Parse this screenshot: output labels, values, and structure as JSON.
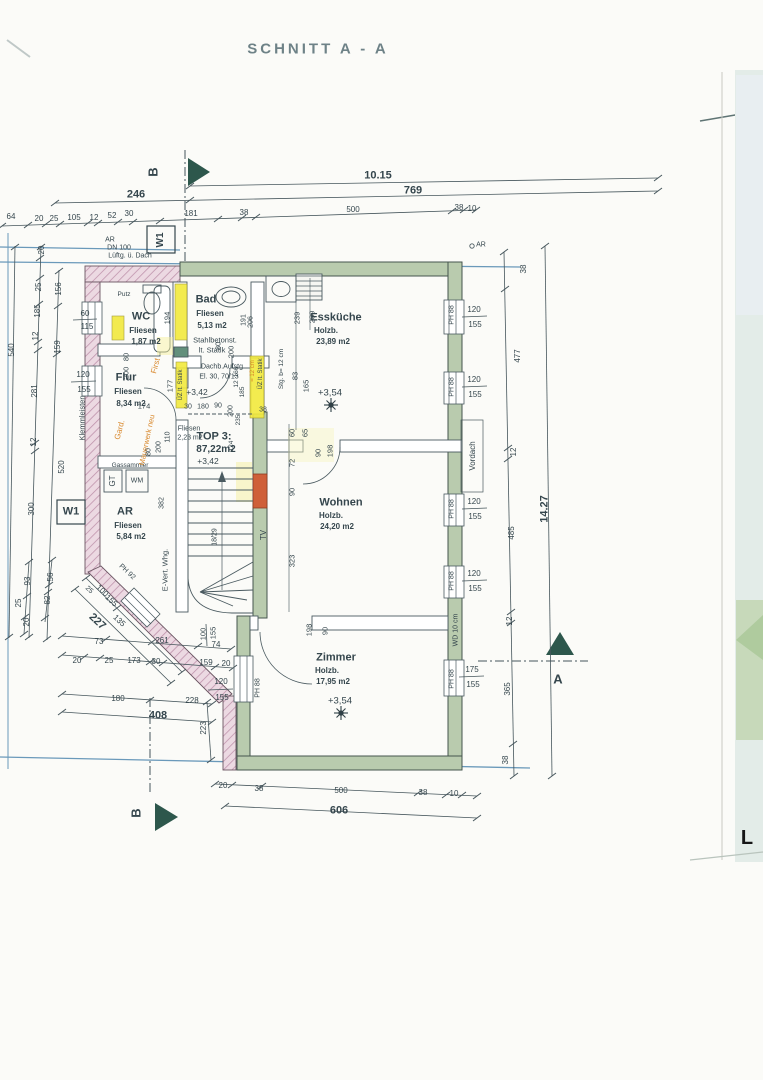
{
  "page": {
    "title": "SCHNITT A - A",
    "photo_letter": "L"
  },
  "palette": {
    "ink": "#35464d",
    "faded": "#6e8287",
    "orange": "#d8872b",
    "red": "#c44f2e",
    "black": "#161616",
    "green_wall": "#b9cbae",
    "pink_wall": "#ecd9e2",
    "yellow": "#f2e93d",
    "blue_line": "#5b8fb4",
    "teal": "#2d574c"
  },
  "rooms": [
    {
      "name": "WC",
      "finish": "Fliesen",
      "area": "1,87 m2"
    },
    {
      "name": "Bad",
      "finish": "Fliesen",
      "area": "5,13 m2",
      "note": "Stahlbetonst. lt. Statik"
    },
    {
      "name": "Flur",
      "finish": "Fliesen",
      "area": "8,34 m2"
    },
    {
      "name": "AR",
      "finish": "Fliesen",
      "area": "5,84 m2"
    },
    {
      "name": "Essküche",
      "finish": "Holzb.",
      "area": "23,89 m2",
      "level": "+3,54"
    },
    {
      "name": "Wohnen",
      "finish": "Holzb.",
      "area": "24,20 m2"
    },
    {
      "name": "Zimmer",
      "finish": "Holzb.",
      "area": "17,95 m2",
      "level": "+3,54"
    },
    {
      "name": "TOP 3:",
      "area": "87,22m2"
    }
  ],
  "labels": [
    {
      "n": "drawing-title",
      "t": "SCHNITT A - A",
      "x": 318,
      "y": 49,
      "s": 15,
      "c": "faded",
      "w": 600,
      "ls": 3
    },
    {
      "n": "photo-letter",
      "t": "L",
      "x": 747,
      "y": 838,
      "s": 20,
      "w": 700,
      "c": "black"
    },
    {
      "n": "dim-total-top",
      "t": "10.15",
      "x": 378,
      "y": 176,
      "s": 11,
      "w": 600
    },
    {
      "t": "246",
      "x": 136,
      "y": 195,
      "s": 11,
      "w": 600
    },
    {
      "t": "769",
      "x": 413,
      "y": 191,
      "s": 11,
      "w": 600
    },
    {
      "t": "64",
      "x": 11,
      "y": 217
    },
    {
      "t": "20",
      "x": 39,
      "y": 219
    },
    {
      "t": "25",
      "x": 54,
      "y": 219
    },
    {
      "t": "105",
      "x": 74,
      "y": 218
    },
    {
      "t": "12",
      "x": 94,
      "y": 218
    },
    {
      "t": "52",
      "x": 112,
      "y": 216
    },
    {
      "t": "30",
      "x": 129,
      "y": 214
    },
    {
      "t": "181",
      "x": 191,
      "y": 214
    },
    {
      "t": "38",
      "x": 244,
      "y": 213
    },
    {
      "t": "500",
      "x": 353,
      "y": 210
    },
    {
      "t": "38",
      "x": 459,
      "y": 208
    },
    {
      "t": "10",
      "x": 472,
      "y": 209
    },
    {
      "n": "section-b-top",
      "t": "B",
      "x": 153,
      "y": 172,
      "s": 13,
      "r": -90,
      "w": 600
    },
    {
      "n": "section-b-bottom",
      "t": "B",
      "x": 136,
      "y": 813,
      "s": 13,
      "r": -90,
      "w": 600
    },
    {
      "n": "section-a",
      "t": "A",
      "x": 558,
      "y": 679,
      "s": 13,
      "w": 600
    },
    {
      "n": "wall-tag-w1-top",
      "t": "W1",
      "x": 161,
      "y": 240,
      "s": 10,
      "r": -90,
      "w": 700
    },
    {
      "n": "wall-tag-w1-left",
      "t": "W1",
      "x": 71,
      "y": 512,
      "s": 11,
      "w": 700
    },
    {
      "t": "AR",
      "x": 110,
      "y": 240,
      "s": 7
    },
    {
      "t": "DN 100",
      "x": 119,
      "y": 248,
      "s": 7
    },
    {
      "t": "Lüftg. ü. Dach",
      "x": 130,
      "y": 256,
      "s": 7
    },
    {
      "t": "AR",
      "x": 481,
      "y": 245,
      "s": 7
    },
    {
      "n": "room-wc",
      "t": "WC",
      "x": 141,
      "y": 317,
      "s": 11,
      "w": 700
    },
    {
      "t": "Fliesen",
      "x": 143,
      "y": 331,
      "s": 8,
      "w": 600
    },
    {
      "t": "1,87 m2",
      "x": 146,
      "y": 342,
      "s": 8,
      "w": 600
    },
    {
      "n": "room-bad",
      "t": "Bad",
      "x": 206,
      "y": 300,
      "s": 11,
      "w": 700
    },
    {
      "t": "Fliesen",
      "x": 210,
      "y": 314,
      "s": 8,
      "w": 600
    },
    {
      "t": "5,13 m2",
      "x": 212,
      "y": 326,
      "s": 8,
      "w": 600
    },
    {
      "t": "Stahlbetonst.",
      "x": 215,
      "y": 340,
      "s": 7.5
    },
    {
      "t": "lt. Statik",
      "x": 212,
      "y": 350,
      "s": 7.5
    },
    {
      "n": "room-flur",
      "t": "Flur",
      "x": 126,
      "y": 378,
      "s": 11,
      "w": 700
    },
    {
      "t": "Fliesen",
      "x": 128,
      "y": 392,
      "s": 8,
      "w": 600
    },
    {
      "t": "8,34 m2",
      "x": 131,
      "y": 404,
      "s": 8,
      "w": 600
    },
    {
      "n": "room-ar",
      "t": "AR",
      "x": 125,
      "y": 512,
      "s": 11,
      "w": 700
    },
    {
      "t": "Fliesen",
      "x": 128,
      "y": 526,
      "s": 8,
      "w": 600
    },
    {
      "t": "5,84 m2",
      "x": 131,
      "y": 537,
      "s": 8,
      "w": 600
    },
    {
      "n": "room-esskueche",
      "t": "Essküche",
      "x": 336,
      "y": 318,
      "s": 11,
      "w": 700
    },
    {
      "t": "Holzb.",
      "x": 326,
      "y": 331,
      "s": 8,
      "w": 600
    },
    {
      "t": "23,89 m2",
      "x": 333,
      "y": 342,
      "s": 8,
      "w": 600
    },
    {
      "n": "room-wohnen",
      "t": "Wohnen",
      "x": 341,
      "y": 503,
      "s": 11,
      "w": 700
    },
    {
      "t": "Holzb.",
      "x": 331,
      "y": 516,
      "s": 8,
      "w": 600
    },
    {
      "t": "24,20 m2",
      "x": 337,
      "y": 527,
      "s": 8,
      "w": 600
    },
    {
      "n": "room-zimmer",
      "t": "Zimmer",
      "x": 336,
      "y": 658,
      "s": 11,
      "w": 700
    },
    {
      "t": "Holzb.",
      "x": 327,
      "y": 671,
      "s": 8,
      "w": 600
    },
    {
      "t": "17,95 m2",
      "x": 333,
      "y": 682,
      "s": 8,
      "w": 600
    },
    {
      "n": "unit-label",
      "t": "TOP 3:",
      "x": 214,
      "y": 437,
      "s": 11,
      "w": 700
    },
    {
      "n": "unit-area",
      "t": "87,22m2",
      "x": 216,
      "y": 450,
      "s": 10,
      "w": 700
    },
    {
      "t": "Fliesen",
      "x": 189,
      "y": 429,
      "s": 7
    },
    {
      "t": "2,23 m2",
      "x": 190,
      "y": 438,
      "s": 7
    },
    {
      "n": "level-esskueche",
      "t": "+3,54",
      "x": 330,
      "y": 393,
      "s": 9.5
    },
    {
      "n": "level-zimmer",
      "t": "+3,54",
      "x": 340,
      "y": 701,
      "s": 9.5
    },
    {
      "t": "+3,42",
      "x": 197,
      "y": 392,
      "s": 8.5
    },
    {
      "t": "+3,42",
      "x": 208,
      "y": 461,
      "s": 8.5
    },
    {
      "t": "Dachb.Aufstg",
      "x": 222,
      "y": 367,
      "s": 7
    },
    {
      "t": "El. 30, 70/13",
      "x": 219,
      "y": 377,
      "s": 7
    },
    {
      "t": "Putz",
      "x": 124,
      "y": 295,
      "s": 6.5
    },
    {
      "t": "Gassammler",
      "x": 130,
      "y": 466,
      "s": 6.5
    },
    {
      "t": "WM",
      "x": 137,
      "y": 481,
      "s": 7
    },
    {
      "t": "GT",
      "x": 113,
      "y": 481,
      "s": 8,
      "r": -90
    },
    {
      "t": "E-Vert. Whg.",
      "x": 165,
      "y": 570,
      "s": 7.5,
      "r": -90
    },
    {
      "t": "Klemmleisten",
      "x": 82,
      "y": 418,
      "s": 7.5,
      "r": -90
    },
    {
      "t": "TV",
      "x": 264,
      "y": 535,
      "s": 8,
      "r": -90
    },
    {
      "t": "Vordach",
      "x": 473,
      "y": 456,
      "s": 8,
      "r": -90
    },
    {
      "t": "WD 10 cm",
      "x": 456,
      "y": 630,
      "s": 7,
      "r": -90
    },
    {
      "t": "First",
      "x": 156,
      "y": 366,
      "s": 8,
      "r": -75,
      "c": "orange"
    },
    {
      "t": "Gard.",
      "x": 120,
      "y": 430,
      "s": 8,
      "r": -75,
      "c": "orange"
    },
    {
      "t": "Mauerwerk neu",
      "x": 147,
      "y": 440,
      "s": 7.5,
      "r": -78,
      "c": "orange"
    },
    {
      "t": "194",
      "x": 167,
      "y": 318,
      "s": 7.5,
      "r": -90
    },
    {
      "t": "191",
      "x": 244,
      "y": 320,
      "s": 7,
      "r": -90
    },
    {
      "t": "206",
      "x": 251,
      "y": 322,
      "s": 7,
      "r": -90
    },
    {
      "t": "80",
      "x": 126,
      "y": 357,
      "s": 7.5,
      "r": -90
    },
    {
      "t": "200",
      "x": 126,
      "y": 373,
      "s": 7.5,
      "r": -90
    },
    {
      "t": "80",
      "x": 218,
      "y": 346,
      "s": 7.5,
      "r": -90
    },
    {
      "t": "200",
      "x": 231,
      "y": 352,
      "s": 7.5,
      "r": -90
    },
    {
      "t": "174",
      "x": 144,
      "y": 406,
      "s": 7.5
    },
    {
      "t": "177",
      "x": 170,
      "y": 386,
      "s": 7.5,
      "r": -90
    },
    {
      "t": "ÜZ lt. Statik",
      "x": 181,
      "y": 385,
      "s": 6,
      "r": -90
    },
    {
      "t": "= 12 cm",
      "x": 253,
      "y": 371,
      "s": 6,
      "r": -90,
      "c": "orange"
    },
    {
      "t": "ÜZ lt. Statik",
      "x": 261,
      "y": 374,
      "s": 6,
      "r": -90
    },
    {
      "t": "Stg. b= 12 cm",
      "x": 282,
      "y": 369,
      "s": 6.5,
      "r": -90
    },
    {
      "t": "239",
      "x": 297,
      "y": 318,
      "s": 7.5,
      "r": -90
    },
    {
      "t": "239",
      "x": 312,
      "y": 317,
      "s": 7.5,
      "r": -90
    },
    {
      "t": "83",
      "x": 295,
      "y": 376,
      "s": 7.5,
      "r": -90
    },
    {
      "t": "165",
      "x": 306,
      "y": 386,
      "s": 7.5,
      "r": -90
    },
    {
      "t": "60",
      "x": 292,
      "y": 433,
      "s": 7.5,
      "r": -90
    },
    {
      "t": "65",
      "x": 305,
      "y": 433,
      "s": 7.5,
      "r": -90
    },
    {
      "t": "72",
      "x": 292,
      "y": 463,
      "s": 7.5,
      "r": -90
    },
    {
      "t": "90",
      "x": 292,
      "y": 492,
      "s": 7.5,
      "r": -90
    },
    {
      "t": "90",
      "x": 318,
      "y": 453,
      "s": 7.5,
      "r": -90
    },
    {
      "t": "198",
      "x": 330,
      "y": 451,
      "s": 7.5,
      "r": -90
    },
    {
      "t": "323",
      "x": 292,
      "y": 561,
      "s": 7.5,
      "r": -90
    },
    {
      "t": "198",
      "x": 309,
      "y": 630,
      "s": 7.5,
      "r": -90
    },
    {
      "t": "90",
      "x": 325,
      "y": 631,
      "s": 7.5,
      "r": -90
    },
    {
      "t": "18/29",
      "x": 215,
      "y": 537,
      "s": 7,
      "r": -90
    },
    {
      "t": "30",
      "x": 188,
      "y": 407,
      "s": 7
    },
    {
      "t": "180",
      "x": 203,
      "y": 407,
      "s": 7
    },
    {
      "t": "90",
      "x": 218,
      "y": 406,
      "s": 7
    },
    {
      "t": "200",
      "x": 231,
      "y": 411,
      "s": 7,
      "r": -90
    },
    {
      "t": "166",
      "x": 237,
      "y": 372,
      "s": 6.5,
      "r": -90
    },
    {
      "t": "12",
      "x": 237,
      "y": 384,
      "s": 6.5,
      "r": -90
    },
    {
      "t": "185",
      "x": 243,
      "y": 392,
      "s": 6.5,
      "r": -90
    },
    {
      "t": "235",
      "x": 239,
      "y": 420,
      "s": 6.5,
      "r": -90
    },
    {
      "t": "124",
      "x": 232,
      "y": 446,
      "s": 6.5,
      "r": -90
    },
    {
      "t": "38",
      "x": 263,
      "y": 410,
      "s": 7
    },
    {
      "t": "382",
      "x": 162,
      "y": 503,
      "s": 7,
      "r": -90
    },
    {
      "t": "80",
      "x": 149,
      "y": 452,
      "s": 7,
      "r": -90
    },
    {
      "t": "200",
      "x": 159,
      "y": 447,
      "s": 7,
      "r": -90
    },
    {
      "t": "110",
      "x": 168,
      "y": 437,
      "s": 7,
      "r": -90
    },
    {
      "t": "540",
      "x": 12,
      "y": 350,
      "s": 8,
      "r": -90
    },
    {
      "t": "20",
      "x": 42,
      "y": 250,
      "s": 8,
      "r": -90
    },
    {
      "t": "25",
      "x": 39,
      "y": 287,
      "s": 8,
      "r": -90
    },
    {
      "t": "185",
      "x": 38,
      "y": 311,
      "s": 8,
      "r": -90
    },
    {
      "t": "12",
      "x": 36,
      "y": 336,
      "s": 8,
      "r": -90
    },
    {
      "t": "281",
      "x": 35,
      "y": 391,
      "s": 8,
      "r": -90
    },
    {
      "t": "12",
      "x": 34,
      "y": 442,
      "s": 8,
      "r": -90
    },
    {
      "t": "520",
      "x": 62,
      "y": 467,
      "s": 8,
      "r": -90
    },
    {
      "t": "300",
      "x": 32,
      "y": 509,
      "s": 8,
      "r": -90
    },
    {
      "t": "156",
      "x": 59,
      "y": 289,
      "s": 8,
      "r": -90
    },
    {
      "t": "159",
      "x": 58,
      "y": 347,
      "s": 8,
      "r": -90
    },
    {
      "t": "60",
      "x": 85,
      "y": 314,
      "s": 8
    },
    {
      "t": "115",
      "x": 87,
      "y": 327,
      "s": 8
    },
    {
      "t": "120",
      "x": 83,
      "y": 375,
      "s": 8
    },
    {
      "t": "155",
      "x": 84,
      "y": 390,
      "s": 8
    },
    {
      "t": "25",
      "x": 19,
      "y": 603,
      "s": 8,
      "r": -90
    },
    {
      "t": "93",
      "x": 28,
      "y": 581,
      "s": 8,
      "r": -90
    },
    {
      "t": "20",
      "x": 27,
      "y": 622,
      "s": 8,
      "r": -90
    },
    {
      "t": "82",
      "x": 48,
      "y": 600,
      "s": 8,
      "r": -90
    },
    {
      "t": "56",
      "x": 51,
      "y": 577,
      "s": 8,
      "r": -90
    },
    {
      "n": "dim-diagonal",
      "t": "227",
      "x": 97,
      "y": 622,
      "s": 11,
      "w": 700,
      "r": 43
    },
    {
      "t": "135",
      "x": 119,
      "y": 621,
      "s": 8,
      "r": 43
    },
    {
      "t": "100",
      "x": 102,
      "y": 591,
      "s": 8,
      "r": 43
    },
    {
      "t": "155",
      "x": 111,
      "y": 601,
      "s": 8,
      "r": 43
    },
    {
      "t": "25",
      "x": 89,
      "y": 590,
      "s": 7,
      "r": 43
    },
    {
      "t": "PH 92",
      "x": 127,
      "y": 572,
      "s": 7,
      "r": 43
    },
    {
      "t": "73",
      "x": 99,
      "y": 642,
      "s": 8
    },
    {
      "t": "261",
      "x": 162,
      "y": 641,
      "s": 8
    },
    {
      "t": "74",
      "x": 216,
      "y": 645,
      "s": 8
    },
    {
      "t": "20",
      "x": 77,
      "y": 661,
      "s": 8
    },
    {
      "t": "25",
      "x": 109,
      "y": 661,
      "s": 8
    },
    {
      "t": "173",
      "x": 134,
      "y": 661,
      "s": 8
    },
    {
      "t": "30",
      "x": 156,
      "y": 662,
      "s": 8
    },
    {
      "t": "159",
      "x": 206,
      "y": 663,
      "s": 8
    },
    {
      "t": "20",
      "x": 226,
      "y": 664,
      "s": 8
    },
    {
      "t": "100",
      "x": 203,
      "y": 634,
      "s": 7.5,
      "r": -90
    },
    {
      "t": "155",
      "x": 213,
      "y": 633,
      "s": 7.5,
      "r": -90
    },
    {
      "t": "120",
      "x": 221,
      "y": 682,
      "s": 8
    },
    {
      "t": "155",
      "x": 222,
      "y": 698,
      "s": 8
    },
    {
      "t": "180",
      "x": 118,
      "y": 699,
      "s": 8
    },
    {
      "t": "228",
      "x": 192,
      "y": 701,
      "s": 8
    },
    {
      "n": "dim-total-408",
      "t": "408",
      "x": 158,
      "y": 716,
      "s": 11,
      "w": 700
    },
    {
      "t": "223",
      "x": 204,
      "y": 728,
      "s": 8,
      "r": -90
    },
    {
      "t": "PH 88",
      "x": 258,
      "y": 688,
      "s": 7,
      "r": -90
    },
    {
      "t": "PH 88",
      "x": 452,
      "y": 315,
      "s": 7,
      "r": -90
    },
    {
      "t": "PH 88",
      "x": 452,
      "y": 387,
      "s": 7,
      "r": -90
    },
    {
      "t": "PH 88",
      "x": 452,
      "y": 509,
      "s": 7,
      "r": -90
    },
    {
      "t": "PH 88",
      "x": 452,
      "y": 581,
      "s": 7,
      "r": -90
    },
    {
      "t": "PH 88",
      "x": 452,
      "y": 679,
      "s": 7,
      "r": -90
    },
    {
      "t": "120",
      "x": 474,
      "y": 310,
      "s": 8
    },
    {
      "t": "155",
      "x": 475,
      "y": 325,
      "s": 8
    },
    {
      "t": "120",
      "x": 474,
      "y": 380,
      "s": 8
    },
    {
      "t": "155",
      "x": 475,
      "y": 395,
      "s": 8
    },
    {
      "t": "120",
      "x": 474,
      "y": 502,
      "s": 8
    },
    {
      "t": "155",
      "x": 475,
      "y": 517,
      "s": 8
    },
    {
      "t": "120",
      "x": 474,
      "y": 574,
      "s": 8
    },
    {
      "t": "155",
      "x": 475,
      "y": 589,
      "s": 8
    },
    {
      "t": "175",
      "x": 472,
      "y": 670,
      "s": 8
    },
    {
      "t": "155",
      "x": 473,
      "y": 685,
      "s": 8
    },
    {
      "t": "38",
      "x": 524,
      "y": 269,
      "s": 8,
      "r": -90
    },
    {
      "t": "477",
      "x": 518,
      "y": 356,
      "s": 8,
      "r": -90
    },
    {
      "t": "12",
      "x": 514,
      "y": 452,
      "s": 8,
      "r": -90
    },
    {
      "t": "485",
      "x": 512,
      "y": 533,
      "s": 8,
      "r": -90
    },
    {
      "t": "12",
      "x": 510,
      "y": 621,
      "s": 8,
      "r": -90
    },
    {
      "t": "365",
      "x": 508,
      "y": 689,
      "s": 8,
      "r": -90
    },
    {
      "t": "38",
      "x": 506,
      "y": 760,
      "s": 8,
      "r": -90
    },
    {
      "n": "dim-total-right",
      "t": "14.27",
      "x": 545,
      "y": 509,
      "s": 11,
      "w": 700,
      "r": -90
    },
    {
      "t": "20",
      "x": 223,
      "y": 786,
      "s": 8
    },
    {
      "t": "38",
      "x": 259,
      "y": 789,
      "s": 8
    },
    {
      "t": "500",
      "x": 341,
      "y": 791,
      "s": 8
    },
    {
      "t": "38",
      "x": 423,
      "y": 793,
      "s": 8
    },
    {
      "t": "10",
      "x": 454,
      "y": 794,
      "s": 8
    },
    {
      "n": "dim-total-bottom",
      "t": "606",
      "x": 339,
      "y": 811,
      "s": 11,
      "w": 700
    }
  ]
}
